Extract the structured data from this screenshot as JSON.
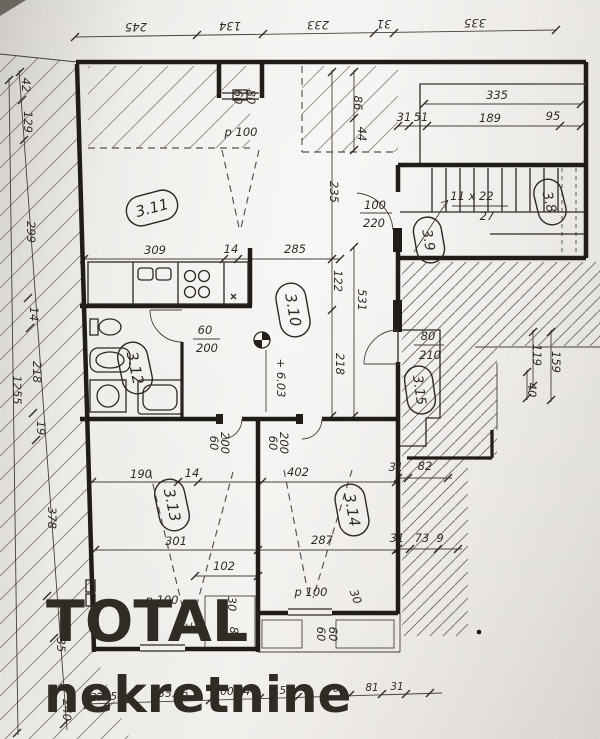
{
  "watermark": {
    "line1": "TOTAL",
    "line2": "nekretnine",
    "color": "#1d7ce9"
  },
  "rooms": {
    "r38": "3.8",
    "r39": "3.9",
    "r310": "3.10",
    "r311": "3.11",
    "r312": "3.12",
    "r313": "3.13",
    "r314": "3.14",
    "r315": "3.15"
  },
  "top_chain": [
    "245",
    "134",
    "233",
    "31",
    "335"
  ],
  "left_chain": [
    "42",
    "129",
    "299",
    "14",
    "218",
    "19",
    "378",
    "35",
    "240"
  ],
  "left_total": "1255",
  "bottom_chain": [
    "27",
    "56",
    "135.46",
    "100.54",
    "0.54",
    "6",
    "81",
    "31"
  ],
  "dims": {
    "d309": "309",
    "d14_kitchen": "14",
    "d285": "285",
    "d235": "235",
    "d86": "86",
    "d44": "44",
    "d122": "122",
    "d531": "531",
    "d218": "218",
    "d335": "335",
    "d31_a": "31",
    "d51": "51",
    "d189": "189",
    "d95": "95",
    "d119": "119",
    "d159": "159",
    "d40": "40",
    "d190": "190",
    "d14_b": "14",
    "d402": "402",
    "d301": "301",
    "d287": "287",
    "d102": "102",
    "d31_b": "31",
    "d82": "82",
    "d31_c": "31",
    "d73": "73",
    "d9": "9",
    "d30_a": "30",
    "d88": "88",
    "d30_b": "30",
    "d60_sill_a": "60",
    "d60_sill_b": "60"
  },
  "stairs": {
    "label_top": "11 x 22",
    "label_bottom": "27"
  },
  "level_mark": "+ 6.03",
  "doors": {
    "entry": {
      "w": "60",
      "h": "80",
      "p": "p 100"
    },
    "stair_door": {
      "w": "100",
      "h": "220"
    },
    "bath_door": {
      "w": "60",
      "h": "200"
    },
    "door_315": {
      "w": "80",
      "h": "210"
    },
    "room13_door": {
      "w": "60",
      "h": "200"
    },
    "room14_door": {
      "w": "60",
      "h": "200"
    },
    "window13": {
      "p": "p 100"
    },
    "window14": {
      "p": "p 100"
    }
  }
}
